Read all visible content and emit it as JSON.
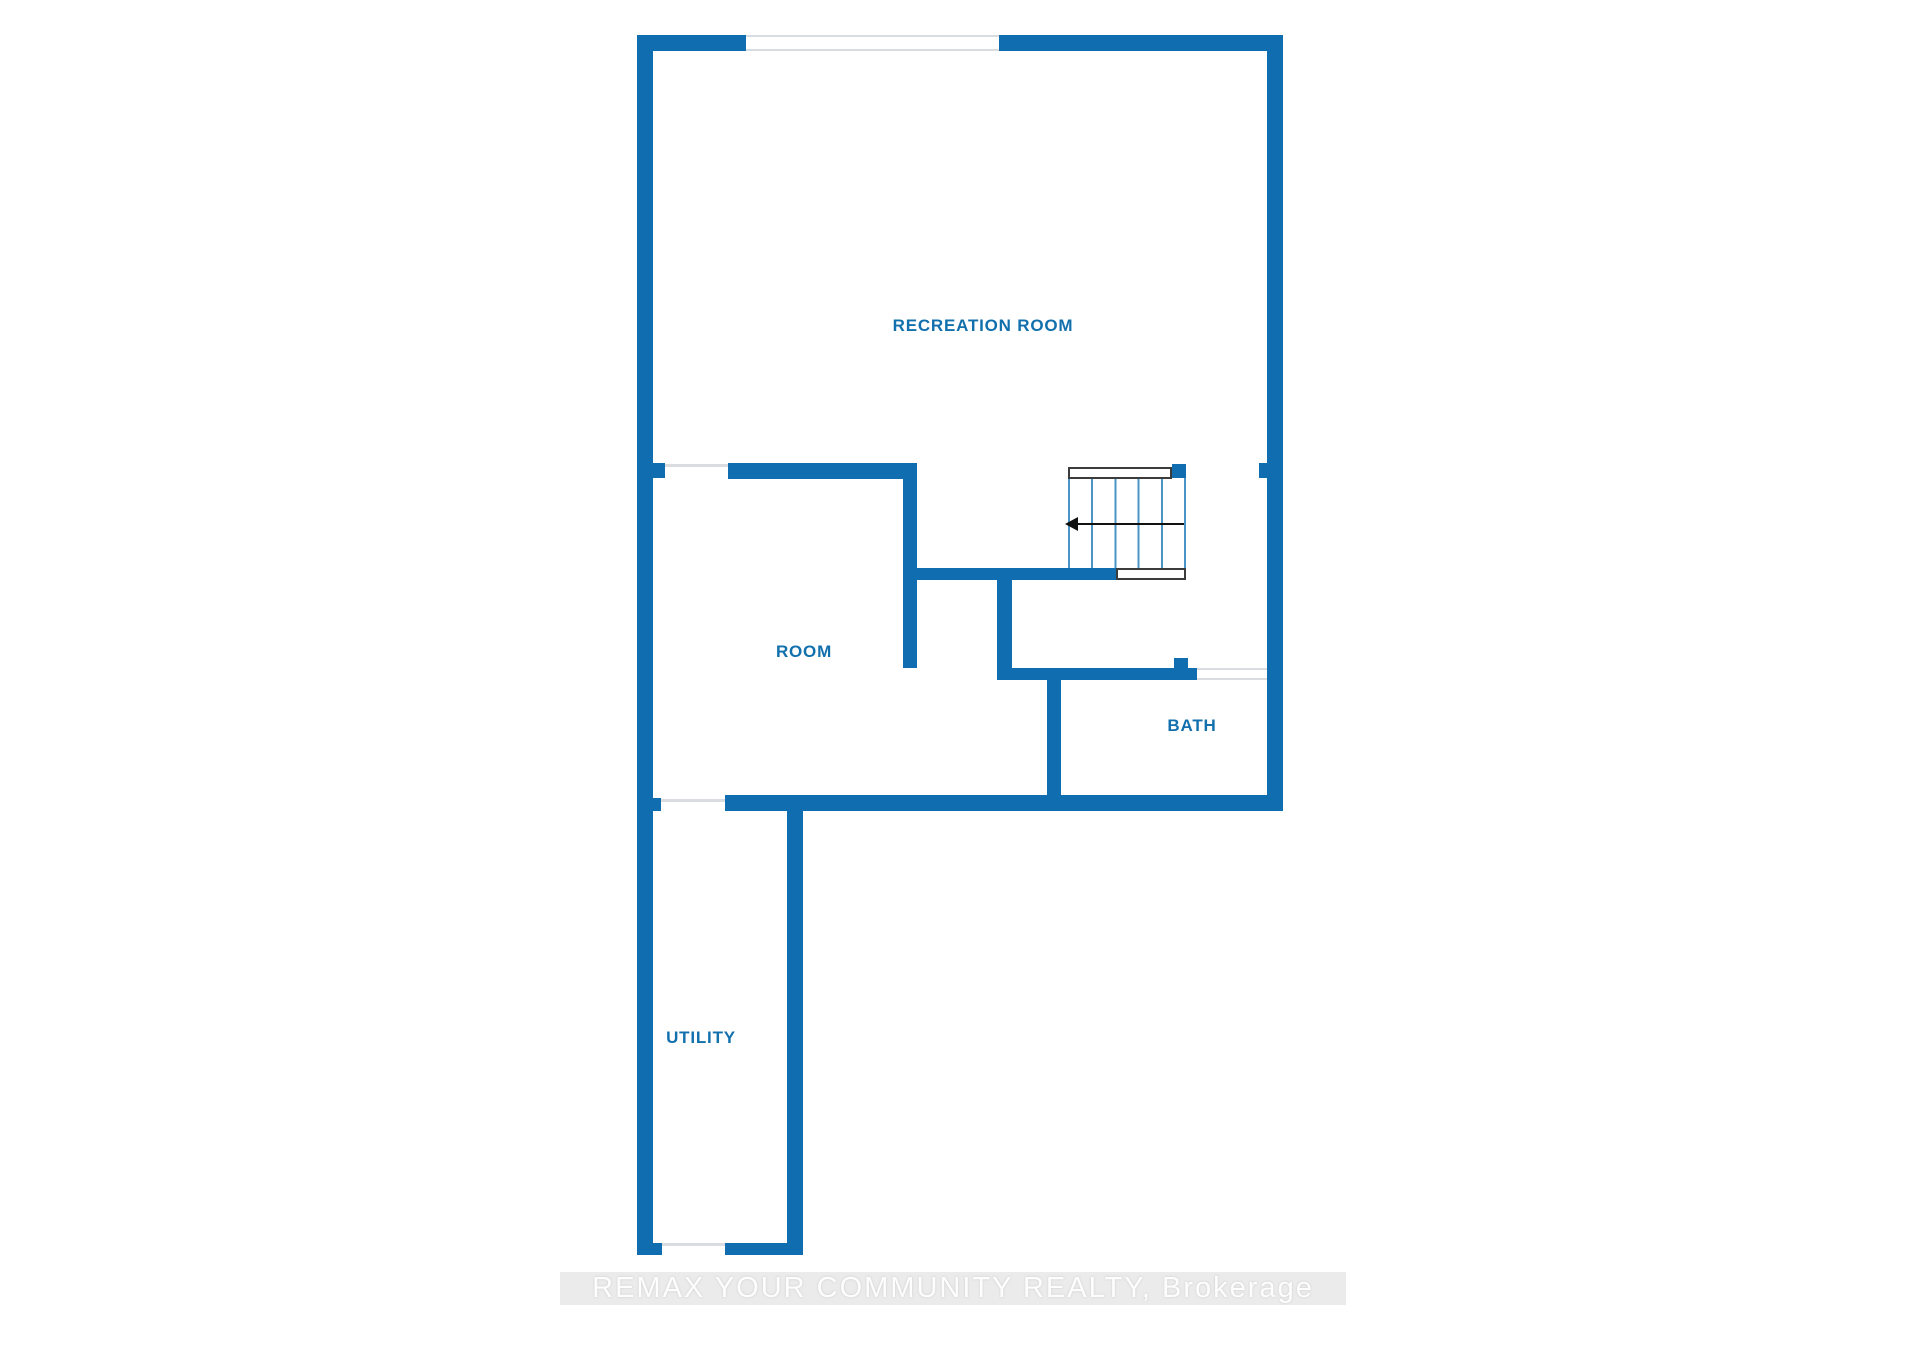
{
  "floor_plan": {
    "rooms": [
      {
        "id": "recreation-room",
        "label": "RECREATION ROOM"
      },
      {
        "id": "room",
        "label": "ROOM"
      },
      {
        "id": "bath",
        "label": "BATH"
      },
      {
        "id": "utility",
        "label": "UTILITY"
      }
    ],
    "stairs": {
      "direction_arrow": "left"
    },
    "colors": {
      "wall": "#0f6db0",
      "room_label_text": "#1270ad",
      "stair_tread_line": "#4a94c6",
      "stair_rail_border": "#3c3c3c",
      "window_line": "#d9dde1",
      "arrow": "#111111",
      "watermark_band": "#ebebeb",
      "watermark_text": "#fdfdfd"
    }
  },
  "watermark": {
    "text": "REMAX YOUR COMMUNITY REALTY, Brokerage"
  }
}
